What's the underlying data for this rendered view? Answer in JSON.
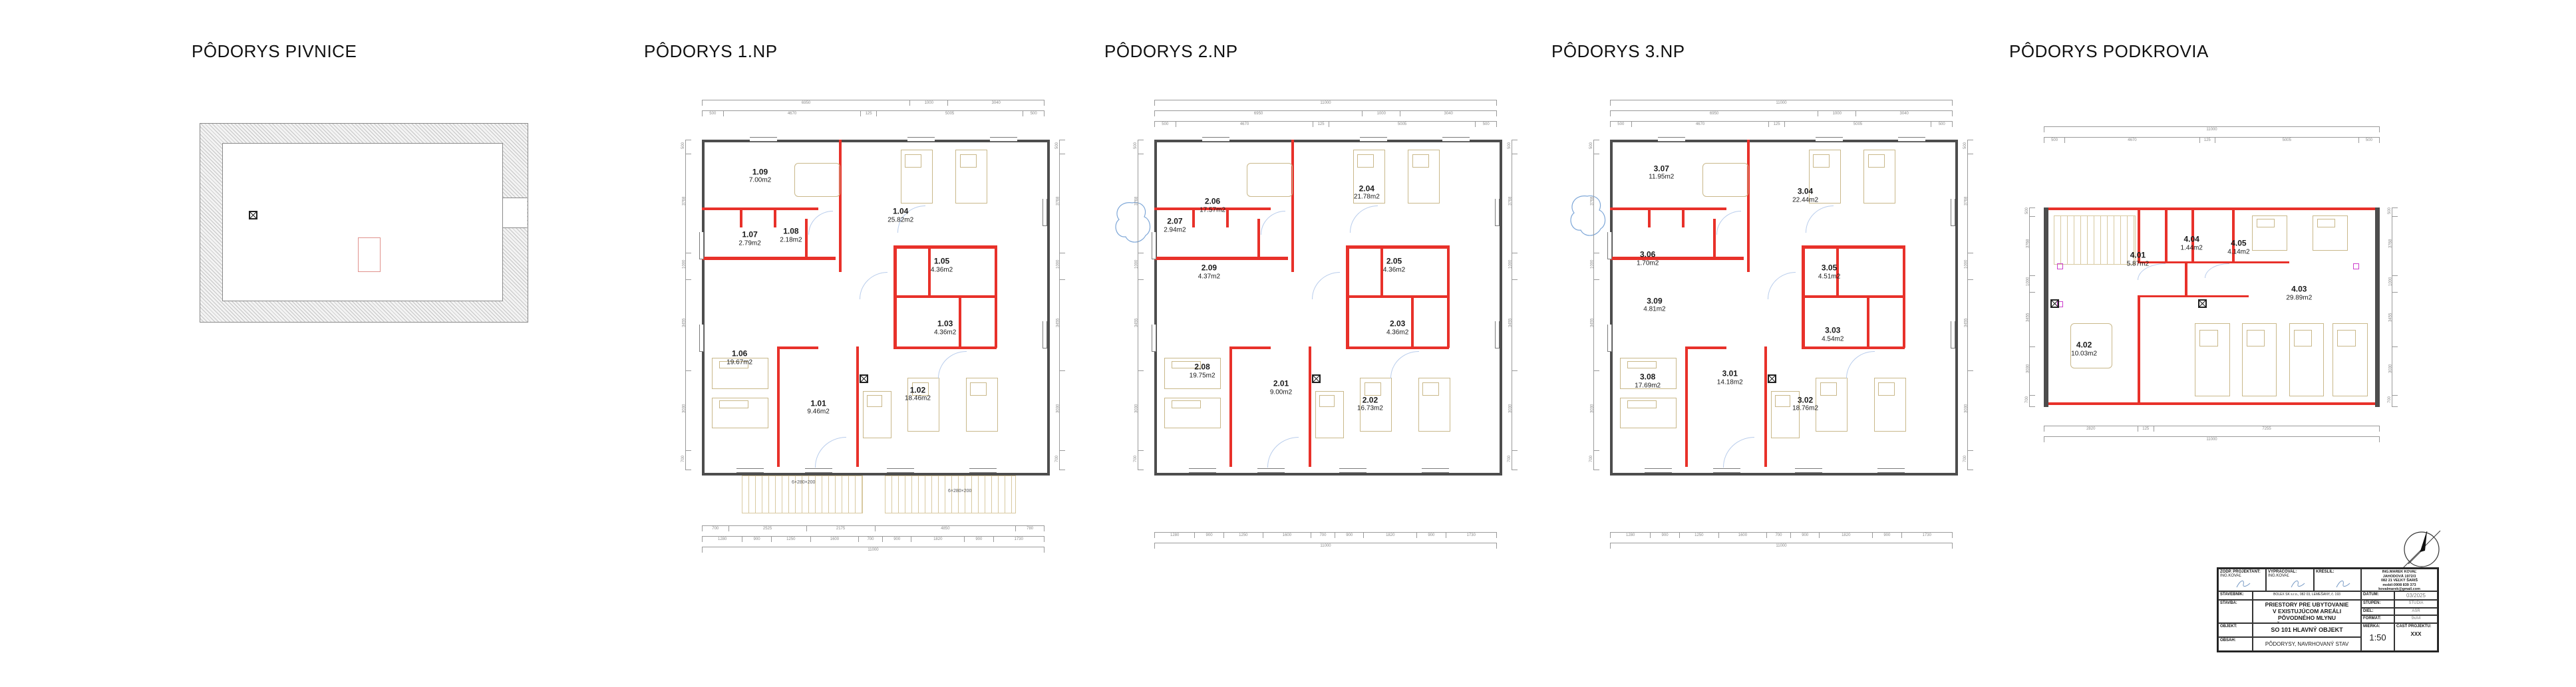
{
  "colors": {
    "new_wall": "#e8312a",
    "existing_wall": "#4d4d4d",
    "furniture": "#c9b88a",
    "door_swing": "#b9cdec",
    "dimension": "#8a8a8a",
    "marker_magenta": "#cc3fcc"
  },
  "plans": [
    {
      "id": "pivnice",
      "title": "PÔDORYS PIVNICE",
      "rooms": []
    },
    {
      "id": "np1",
      "title": "PÔDORYS 1.NP",
      "rooms": [
        {
          "num": "1.01",
          "area": "9.46m2",
          "x": 34,
          "y": 81
        },
        {
          "num": "1.02",
          "area": "18.46m2",
          "x": 63,
          "y": 77
        },
        {
          "num": "1.03",
          "area": "4.36m2",
          "x": 71,
          "y": 57
        },
        {
          "num": "1.04",
          "area": "25.82m2",
          "x": 58,
          "y": 23
        },
        {
          "num": "1.05",
          "area": "4.36m2",
          "x": 70,
          "y": 38
        },
        {
          "num": "1.06",
          "area": "19.67m2",
          "x": 11,
          "y": 66
        },
        {
          "num": "1.07",
          "area": "2.79m2",
          "x": 14,
          "y": 30
        },
        {
          "num": "1.08",
          "area": "2.18m2",
          "x": 26,
          "y": 29
        },
        {
          "num": "1.09",
          "area": "7.00m2",
          "x": 17,
          "y": 11
        }
      ]
    },
    {
      "id": "np2",
      "title": "PÔDORYS 2.NP",
      "rooms": [
        {
          "num": "2.01",
          "area": "9.00m2",
          "x": 37,
          "y": 75
        },
        {
          "num": "2.02",
          "area": "16.73m2",
          "x": 63,
          "y": 80
        },
        {
          "num": "2.03",
          "area": "4.36m2",
          "x": 71,
          "y": 57
        },
        {
          "num": "2.04",
          "area": "21.78m2",
          "x": 62,
          "y": 16
        },
        {
          "num": "2.05",
          "area": "4.36m2",
          "x": 70,
          "y": 38
        },
        {
          "num": "2.06",
          "area": "17.57m2",
          "x": 17,
          "y": 20
        },
        {
          "num": "2.07",
          "area": "2.94m2",
          "x": 6,
          "y": 26
        },
        {
          "num": "2.08",
          "area": "19.75m2",
          "x": 14,
          "y": 70
        },
        {
          "num": "2.09",
          "area": "4.37m2",
          "x": 16,
          "y": 40
        }
      ]
    },
    {
      "id": "np3",
      "title": "PÔDORYS 3.NP",
      "rooms": [
        {
          "num": "3.01",
          "area": "14.18m2",
          "x": 35,
          "y": 72
        },
        {
          "num": "3.02",
          "area": "18.76m2",
          "x": 57,
          "y": 80
        },
        {
          "num": "3.03",
          "area": "4.54m2",
          "x": 65,
          "y": 59
        },
        {
          "num": "3.04",
          "area": "22.44m2",
          "x": 57,
          "y": 17
        },
        {
          "num": "3.05",
          "area": "4.51m2",
          "x": 64,
          "y": 40
        },
        {
          "num": "3.06",
          "area": "1.70m2",
          "x": 11,
          "y": 36
        },
        {
          "num": "3.07",
          "area": "11.95m2",
          "x": 15,
          "y": 10
        },
        {
          "num": "3.08",
          "area": "17.69m2",
          "x": 11,
          "y": 73
        },
        {
          "num": "3.09",
          "area": "4.81m2",
          "x": 13,
          "y": 50
        }
      ]
    },
    {
      "id": "podkrovie",
      "title": "PÔDORYS PODKROVIA",
      "rooms": [
        {
          "num": "4.01",
          "area": "5.87m2",
          "x": 28,
          "y": 26
        },
        {
          "num": "4.02",
          "area": "10.03m2",
          "x": 12,
          "y": 71
        },
        {
          "num": "4.03",
          "area": "29.89m2",
          "x": 76,
          "y": 43
        },
        {
          "num": "4.04",
          "area": "1.44m2",
          "x": 44,
          "y": 18
        },
        {
          "num": "4.05",
          "area": "4.14m2",
          "x": 58,
          "y": 20
        }
      ]
    }
  ],
  "dims": {
    "total_width": "11000",
    "total_height": "11750",
    "top_chain_a": [
      "6950",
      "1000",
      "3040"
    ],
    "top_chain_b": [
      "500",
      "4670",
      "125",
      "5005",
      "500"
    ],
    "bottom_chain_a": [
      "700",
      "2525",
      "2175",
      "4850",
      "780"
    ],
    "bottom_chain_b": [
      "1280",
      "900",
      "1250",
      "1600",
      "700",
      "900",
      "1820",
      "900",
      "1730"
    ],
    "side_chain": [
      "500",
      "3768",
      "1000",
      "3455",
      "3030",
      "700"
    ],
    "podkrovie_bottom": [
      "2820",
      "125",
      "7255"
    ],
    "stair_note_left": "6×280×200",
    "stair_note_right": "6×280×200"
  },
  "titleblock": {
    "zodp_label": "ZODP. PROJEKTANT:",
    "zodp_value": "ING.KOVAĽ",
    "vypracoval_label": "VYPRACOVAL:",
    "vypracoval_value": "ING.KOVAĽ",
    "kreslil_label": "KRESLIL:",
    "contact_1": "ING.MAREK KOVAĽ",
    "contact_2": "JAHODOVÁ 1972/3",
    "contact_3": "082 21 VEĽKÝ ŠARIŠ",
    "contact_4": "mobil:0908 839 373",
    "contact_5": "kovalmarek@gmail.com",
    "stavebnik_label": "STAVEBNÍK:",
    "stavebnik_value": "BOLEX SK s.r.o., 082 03, LEMEŠANY, č. 193",
    "datum_label": "DÁTUM:",
    "datum_value": "03/2025",
    "stavba_label": "STAVBA:",
    "stavba_value_1": "PRIESTORY PRE UBYTOVANIE",
    "stavba_value_2": "V EXISTUJÚCOM AREÁLI PÔVODNÉHO MLYNU",
    "stavba_value_3": "LEMEŠANY, p.č. KN-C 547/2, 547/7",
    "stupen_label": "STUPEŇ:",
    "stupen_value": "ŠTÚDIA",
    "diel_label": "DIEL:",
    "diel_value": "ASR",
    "format_label": "FORMÁT:",
    "format_value": "9xA4",
    "objekt_label": "OBJEKT:",
    "objekt_value": "SO 101   HLAVNÝ OBJEKT",
    "obsah_label": "OBSAH:",
    "obsah_value": "PÔDORYSY, NAVRHOVANÝ STAV",
    "mierka_label": "MIERKA:",
    "mierka_value": "1:50",
    "cast_label": "ČASŤ PROJEKTU:",
    "cast_value": "XXX"
  }
}
